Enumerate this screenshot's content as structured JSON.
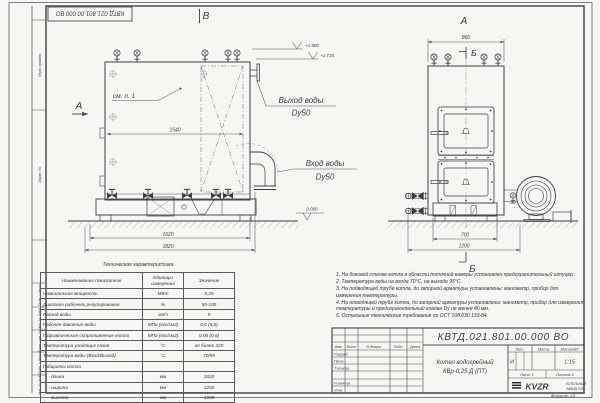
{
  "frame": {
    "stamp_number": "КВТД.021.801.00.000 ВО",
    "format_label": "Формат А3",
    "column_labels": [
      "Перв. примен.",
      "Справ. №",
      "Подп. и дата",
      "Инв. № дубл.",
      "Взам. инв. №",
      "Подп. и дата",
      "Инв. № подл."
    ]
  },
  "front_view": {
    "view_label": "В",
    "section_arrow_label": "А",
    "see_item": "см. п. 1",
    "dim_inner_width": "1540",
    "dim_base": "1620",
    "dim_overall": "1820",
    "elev_top": "+1.900",
    "elev_flange": "+1.735",
    "elev_zero": "0.000",
    "outlet_label": "Выход воды",
    "outlet_dn": "Dy50",
    "inlet_label": "Вход воды",
    "inlet_dn": "Dy50"
  },
  "side_view": {
    "view_label": "А",
    "dim_top": "860",
    "section_top_label": "Б",
    "section_bottom_label": "Б",
    "dim_base": "700",
    "dim_overall": "1200"
  },
  "spec_table": {
    "title": "Техническая характеристика",
    "headers": [
      "Наименование показателя",
      "Единицы измерения",
      "Значение"
    ],
    "rows": [
      [
        "Номинальная мощность",
        "МВт",
        "0,25"
      ],
      [
        "Диапазон рабочего регулирования",
        "%",
        "50-100"
      ],
      [
        "Расход воды",
        "м3/ч",
        "9"
      ],
      [
        "Рабочее давление воды",
        "МПа (кгс/см2)",
        "0,6 (6,0)"
      ],
      [
        "Гидравлическое сопротивление котла",
        "МПа (кгс/см2)",
        "0,06 (0,6)"
      ],
      [
        "Температура уходящих газов",
        "°С",
        "не более 220"
      ],
      [
        "Температура воды (Вход/Выход)",
        "°С",
        "70/95"
      ],
      [
        "Габариты котла",
        "",
        ""
      ],
      [
        "    - длина",
        "мм",
        "1820"
      ],
      [
        "    - ширина",
        "мм",
        "1200"
      ],
      [
        "    - высота",
        "мм",
        "1900"
      ]
    ]
  },
  "notes": [
    "1.  На боковой стенке котла в области топочной камеры установлен предохранительный штуцер",
    "2.  Температура воды на входе 70°С, на выходе 95°С.",
    "3.  На подводящей трубе котла, до запорной арматуры установлены: манометр, прибор для измерения температуры.",
    "4.  На отводящей трубе котла, до запорной арматуры установлены: манометр, прибор для измерения температуры и предохранительный клапан Dу не менее 40 мм.",
    "5.  Остальные технические требования по ОСТ 108.030.133-84."
  ],
  "title_block": {
    "doc_number": "КВТД.021.801.00.000 ВО",
    "header_cols": [
      "Изм.",
      "Лист",
      "N докум.",
      "Подп.",
      "Дата"
    ],
    "roles": [
      "Разраб.",
      "Пров.",
      "Т.контр.",
      "Н.контр.",
      "Утв."
    ],
    "product_line1": "Котел водогрейный",
    "product_line2": "КВр-0,25 Д  (ПТ)",
    "lit_label": "Лит.",
    "lit_value": "И",
    "mass_label": "Масса",
    "scale_label": "Масштаб",
    "scale_value": "1:15",
    "sheet_label": "Лист  1",
    "sheets_label": "Листов  2",
    "logo_text": "KVZR",
    "logo_sub1": "КОТЕЛЬНЫЙ",
    "logo_sub2": "ЗАВОД РЭП"
  }
}
